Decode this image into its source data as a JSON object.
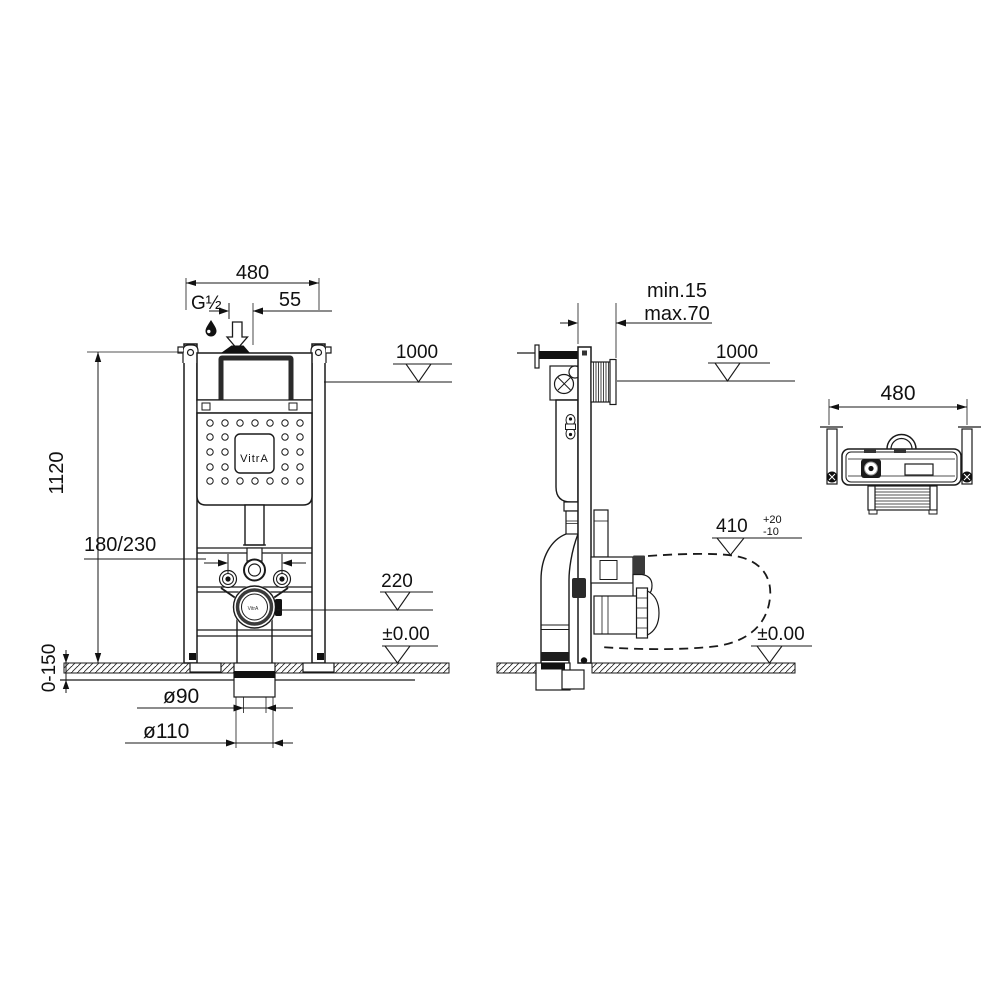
{
  "drawing": {
    "front": {
      "width": "480",
      "inlet": "G½",
      "inlet_offset": "55",
      "flush_level": "1000",
      "height": "1120",
      "fixing_centers": "180/230",
      "outlet_level": "220",
      "floor": "±0.00",
      "adjust_range": "0-150",
      "outlet_inner": "ø90",
      "outlet_outer": "ø110",
      "logo": "VitrA",
      "outlet_logo": "VitrA"
    },
    "side": {
      "distance_min": "min.15",
      "distance_max": "max.70",
      "flush_level": "1000",
      "outlet_level": "410",
      "outlet_tol_plus": "+20",
      "outlet_tol_minus": "-10",
      "floor": "±0.00"
    },
    "top": {
      "width": "480"
    }
  }
}
